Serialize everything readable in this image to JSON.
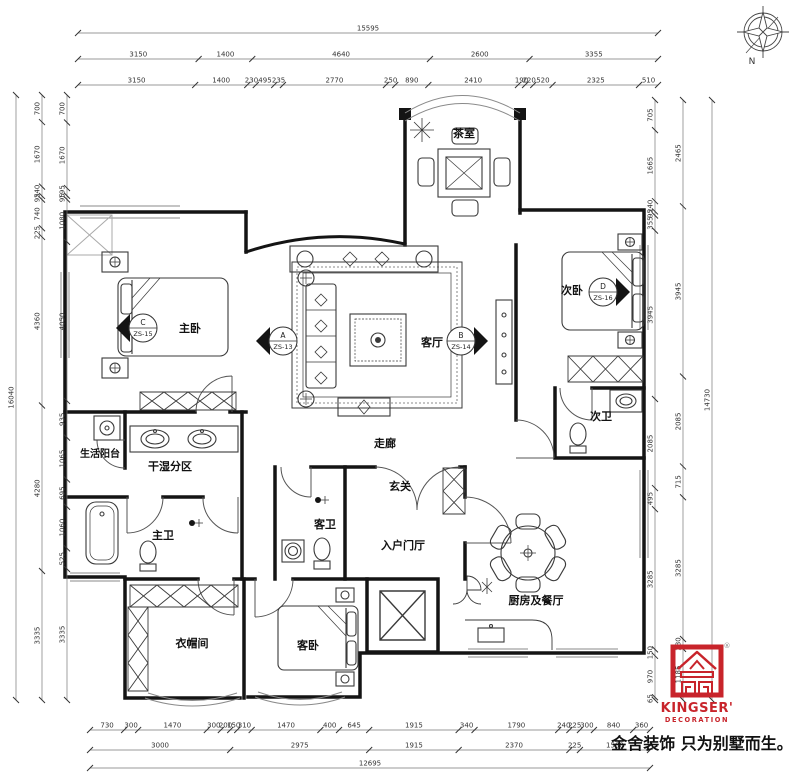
{
  "compass": {
    "north_label": "N"
  },
  "rooms": {
    "tea_room": "茶室",
    "master_bedroom": "主卧",
    "living_room": "客厅",
    "second_bedroom": "次卧",
    "corridor": "走廊",
    "entrance": "玄关",
    "entry_hall": "入户门厅",
    "guest_bath": "客卫",
    "second_bath": "次卫",
    "master_bath": "主卫",
    "wet_dry_zone": "干湿分区",
    "service_balcony": "生活阳台",
    "cloakroom": "衣帽间",
    "guest_bedroom": "客卧",
    "kitchen_dining": "厨房及餐厅"
  },
  "markers": {
    "a": {
      "letter": "A",
      "code": "ZS-13"
    },
    "b": {
      "letter": "B",
      "code": "ZS-14"
    },
    "c": {
      "letter": "C",
      "code": "ZS-15"
    },
    "d": {
      "letter": "D",
      "code": "ZS-16"
    }
  },
  "dimensions": {
    "top": {
      "total": 15595,
      "chain_mid": [
        3150,
        1400,
        4640,
        2600,
        3355
      ],
      "chain_inner": [
        3150,
        1400,
        230,
        495,
        235,
        2770,
        250,
        890,
        2410,
        190,
        220,
        520,
        2325,
        510
      ]
    },
    "left": {
      "total": 16040,
      "chain_mid": [
        700,
        1670,
        240,
        95,
        740,
        225,
        4360,
        4280,
        3335
      ],
      "chain_inner": [
        700,
        1670,
        195,
        95,
        1080,
        4050,
        935,
        1065,
        695,
        1060,
        525,
        3335
      ]
    },
    "right": {
      "total": 14730,
      "chain_mid": [
        2465,
        3945,
        2085,
        715,
        3285,
        230,
        1185
      ],
      "chain_inner": [
        705,
        1665,
        240,
        95,
        355,
        3945,
        2085,
        495,
        3285,
        150,
        970,
        65
      ]
    },
    "bottom": {
      "total": 12695,
      "chain_mid": [
        3000,
        2975,
        1915,
        2370,
        225,
        1500
      ],
      "chain_inner": [
        730,
        300,
        1470,
        300,
        200,
        150,
        310,
        1470,
        400,
        645,
        1915,
        340,
        1790,
        240,
        225,
        300,
        840,
        360
      ]
    }
  },
  "logo": {
    "brand": "KINGSER'",
    "division": "DECORATION",
    "registered": "®",
    "tagline": "金舍装饰 只为别墅而生。"
  },
  "colors": {
    "accent_red": "#C8242B",
    "wall": "#141414",
    "dim_line": "#777777",
    "dim_text": "#333333"
  }
}
